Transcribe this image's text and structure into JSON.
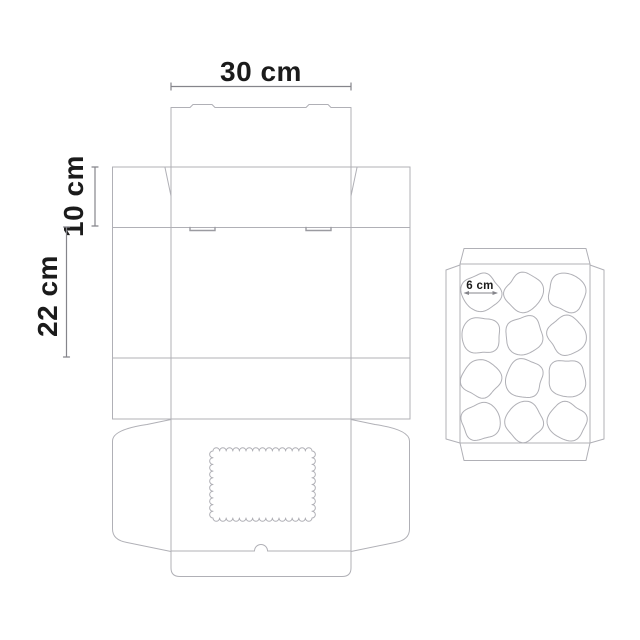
{
  "page": {
    "background": "#ffffff"
  },
  "diagram": {
    "type": "packaging-dieline",
    "box": {
      "width_label": "30 cm",
      "lid_depth_label": "10 cm",
      "body_height_label": "22 cm"
    },
    "tray": {
      "hole_label": "6 cm",
      "rows": 4,
      "cols": 3,
      "col_centers": [
        481,
        524,
        567
      ],
      "row_centers": [
        292.5,
        335.5,
        378.5,
        421.5
      ],
      "hole_radius": 19
    },
    "window": {
      "x": 213,
      "y": 451,
      "width": 99,
      "height": 67,
      "scallop_radius": 3.3
    },
    "colors": {
      "line": "#b0b0b6",
      "line_dark": "#9b9ba1",
      "dimension": "#85858b",
      "text": "#1b1b1b"
    }
  }
}
